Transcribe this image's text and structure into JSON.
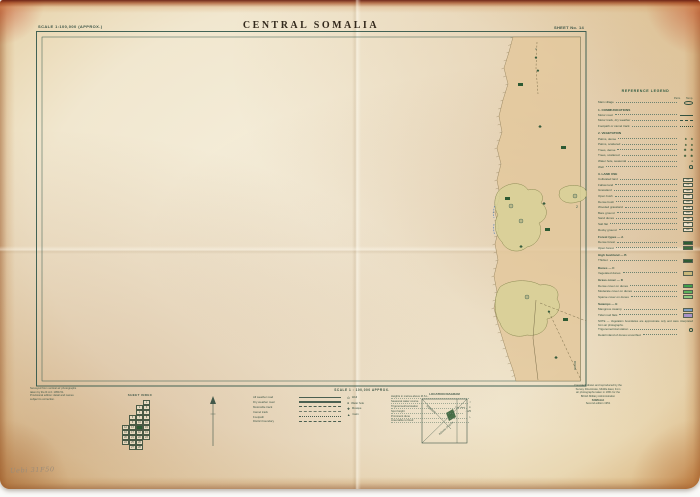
{
  "colors": {
    "frame": "#30564a",
    "title": "#33291c",
    "green_dark": "#2d5a33",
    "green_mid": "#57b35c",
    "green_light": "#8fcb82",
    "blue_swatch": "#7e9ec2",
    "purple_swatch": "#a892c6",
    "blue_ink": "#4a7ab5",
    "tan_strip": "#e3c89c",
    "veg": "#d8d098"
  },
  "header": {
    "scale_label": "SCALE 1:100,000 (APPROX.)",
    "title": "CENTRAL SOMALIA",
    "sheet_label": "SHEET No. 14"
  },
  "legend": {
    "heading": "REFERENCE LEGEND",
    "items": [
      {
        "t": "colheads",
        "a": "Perm.",
        "b": "Temp."
      },
      {
        "t": "item",
        "label": "Main village",
        "sym": "oval"
      },
      {
        "t": "section",
        "label": "1. COMMUNICATIONS"
      },
      {
        "t": "item",
        "label": "Motor road",
        "sym": "line"
      },
      {
        "t": "item",
        "label": "Motor track, dry weather",
        "sym": "dash"
      },
      {
        "t": "item",
        "label": "Footpath or camel track",
        "sym": "dots"
      },
      {
        "t": "section",
        "label": "2. VEGETATION"
      },
      {
        "t": "item",
        "label": "Palms, dense",
        "sym": "palm2"
      },
      {
        "t": "item",
        "label": "Palms, scattered",
        "sym": "palm2"
      },
      {
        "t": "item",
        "label": "Trees, dense",
        "sym": "tree2"
      },
      {
        "t": "item",
        "label": "Trees, scattered",
        "sym": "tree2"
      },
      {
        "t": "item",
        "label": "Water hole, seasonal",
        "sym": "dot"
      },
      {
        "t": "item",
        "label": "Well",
        "sym": "circledot"
      },
      {
        "t": "section",
        "label": "3. LAND USE"
      },
      {
        "t": "item",
        "label": "Cultivated land",
        "sym": "code",
        "code": "CL"
      },
      {
        "t": "item",
        "label": "Fallow land",
        "sym": "code",
        "code": "FL"
      },
      {
        "t": "item",
        "label": "Grassland",
        "sym": "code",
        "code": "GR"
      },
      {
        "t": "item",
        "label": "Open bush",
        "sym": "code",
        "code": "OB"
      },
      {
        "t": "item",
        "label": "Dense bush",
        "sym": "code",
        "code": "DB"
      },
      {
        "t": "item",
        "label": "Wooded grassland",
        "sym": "code",
        "code": "WG"
      },
      {
        "t": "item",
        "label": "Bare ground",
        "sym": "code",
        "code": "BG"
      },
      {
        "t": "item",
        "label": "Sand dunes",
        "sym": "code",
        "code": "SD"
      },
      {
        "t": "item",
        "label": "Salt flat",
        "sym": "code",
        "code": "SF"
      },
      {
        "t": "item",
        "label": "Rocky ground",
        "sym": "code",
        "code": "RK"
      },
      {
        "t": "section",
        "label": "Forest types — A"
      },
      {
        "t": "item",
        "label": "Dense forest",
        "sym": "swatch",
        "color": "#2e5b33"
      },
      {
        "t": "item",
        "label": "Open forest",
        "sym": "swatch",
        "color": "#3c6b3c"
      },
      {
        "t": "section",
        "label": "High bushland — B"
      },
      {
        "t": "item",
        "label": "Thicket",
        "sym": "swatch",
        "color": "#2e5b33"
      },
      {
        "t": "section",
        "label": "Dunes — C"
      },
      {
        "t": "item",
        "label": "Vegetated dunes",
        "sym": "swatch",
        "color": "#c9b87a"
      },
      {
        "t": "section",
        "label": "Grass cover — D"
      },
      {
        "t": "item",
        "label": "Dense cover on dunes",
        "sym": "swatch",
        "color": "#3fa04a"
      },
      {
        "t": "item",
        "label": "Moderate cover on dunes",
        "sym": "swatch",
        "color": "#5cb35c"
      },
      {
        "t": "item",
        "label": "Sparse cover on dunes",
        "sym": "swatch",
        "color": "#8fcb82"
      },
      {
        "t": "section",
        "label": "Swamps — E"
      },
      {
        "t": "item",
        "label": "Mangrove swamp",
        "sym": "swatch",
        "color": "#7e9ec2"
      },
      {
        "t": "item",
        "label": "Tidal mud flats",
        "sym": "swatch",
        "color": "#a892c6"
      },
      {
        "t": "note",
        "label": "NOTE — Vegetation boundaries are approximate only and were interpreted from air photographs."
      },
      {
        "t": "item",
        "label": "Trigonometrical station",
        "sym": "circledot"
      },
      {
        "t": "item",
        "label": "Detail inland of dunes unverified",
        "sym": "none"
      }
    ]
  },
  "map": {
    "coastal_strip": {
      "fill": "#e3c89c",
      "edge": [
        [
          513,
          37
        ],
        [
          509,
          52
        ],
        [
          504,
          68
        ],
        [
          508,
          84
        ],
        [
          503,
          100
        ],
        [
          499,
          116
        ],
        [
          502,
          132
        ],
        [
          497,
          148
        ],
        [
          501,
          164
        ],
        [
          497,
          180
        ],
        [
          500,
          196
        ],
        [
          495,
          212
        ],
        [
          499,
          228
        ],
        [
          495,
          244
        ],
        [
          498,
          260
        ],
        [
          494,
          276
        ],
        [
          497,
          292
        ],
        [
          494,
          308
        ],
        [
          498,
          324
        ],
        [
          503,
          340
        ],
        [
          508,
          356
        ],
        [
          513,
          370
        ],
        [
          516,
          381
        ]
      ]
    },
    "veg_fill": "#d8d098",
    "vegetation_polygons": [
      "M502,188C512,181 524,183 528,190C538,187 546,195 541,203C549,208 548,219 539,223C544,232 538,245 527,247C518,255 505,250 502,242C495,235 493,223 498,215C492,205 495,192 502,188Z",
      "M560,190C566,184 580,184 585,189C589,195 585,201 577,202C568,205 560,201 559,195Z",
      "M500,287C510,279 530,279 540,285C553,283 561,291 557,299C563,307 557,317 547,319C549,329 539,337 527,335C515,339 503,333 500,323C494,315 493,297 500,287Z"
    ],
    "tracks": [
      {
        "d": "M537,42 L536,68 L538,94",
        "dash": "2,1.6"
      },
      {
        "d": "M536,300 L533,338 L538,380",
        "dash": ""
      },
      {
        "d": "M540,303 L586,321",
        "dash": "2.6,1.8"
      },
      {
        "d": "M549,312 L581,380",
        "dash": "2.6,1.8"
      }
    ],
    "wells": [
      {
        "x": 521,
        "y": 221
      },
      {
        "x": 575,
        "y": 196
      },
      {
        "x": 527,
        "y": 297
      },
      {
        "x": 511,
        "y": 206
      }
    ],
    "buildings": [
      {
        "x": 518,
        "y": 83
      },
      {
        "x": 561,
        "y": 146
      },
      {
        "x": 545,
        "y": 228
      },
      {
        "x": 563,
        "y": 318
      },
      {
        "x": 505,
        "y": 197
      }
    ],
    "trees": [
      {
        "x": 536,
        "y": 59,
        "g": "♠"
      },
      {
        "x": 538,
        "y": 72,
        "g": "♠"
      },
      {
        "x": 540,
        "y": 128,
        "g": "♣"
      },
      {
        "x": 544,
        "y": 205,
        "g": "♣"
      },
      {
        "x": 521,
        "y": 248,
        "g": "♣"
      },
      {
        "x": 556,
        "y": 359,
        "g": "♣"
      },
      {
        "x": 549,
        "y": 313,
        "g": "♠"
      }
    ],
    "labels": [
      {
        "text": "2",
        "x": 577,
        "y": 208
      },
      {
        "text": "1",
        "x": 536,
        "y": 50,
        "s": 3
      }
    ]
  },
  "footer": {
    "left_note_lines": [
      "Surveyed from vertical air photographs",
      "taken by the R.A.F. 1950-51.",
      "Provisional edition: detail and names",
      "subject to correction."
    ],
    "sheet_index": {
      "title": "SHEET INDEX",
      "active": "14",
      "rows": [
        {
          "s": 3,
          "n": [
            "1"
          ]
        },
        {
          "s": 2,
          "n": [
            "2",
            "3"
          ]
        },
        {
          "s": 2,
          "n": [
            "4",
            "5"
          ]
        },
        {
          "s": 1,
          "n": [
            "6",
            "7",
            "8"
          ]
        },
        {
          "s": 1,
          "n": [
            "9",
            "10",
            "11"
          ]
        },
        {
          "s": 0,
          "n": [
            "12",
            "13",
            "14",
            "15"
          ]
        },
        {
          "s": 0,
          "n": [
            "16",
            "17",
            "18",
            "19"
          ]
        },
        {
          "s": 0,
          "n": [
            "20",
            "21",
            "22",
            "23"
          ]
        },
        {
          "s": 0,
          "n": [
            "24",
            "25",
            "26"
          ]
        },
        {
          "s": 1,
          "n": [
            "27",
            "28"
          ]
        }
      ]
    },
    "conversion": {
      "heading": "SCALE 1 : 100,000 APPROX.",
      "left_rows": [
        {
          "label": "All weather road",
          "style": "solid"
        },
        {
          "label": "Dry weather road",
          "style": "double"
        },
        {
          "label": "Motorable track",
          "style": "dash"
        },
        {
          "label": "Camel track",
          "style": "dashdot"
        },
        {
          "label": "Footpath",
          "style": "dots"
        },
        {
          "label": "District boundary",
          "style": "dash"
        }
      ],
      "mid_rows": [
        {
          "g": "⊙",
          "label": "Well"
        },
        {
          "g": "●",
          "label": "Water hole"
        },
        {
          "g": "✚",
          "label": "Mosque"
        },
        {
          "g": "▲",
          "label": "Cairn"
        }
      ],
      "right_rows": [
        {
          "label": "Heights in metres above M.S.L.",
          "tail": ""
        },
        {
          "label": "Seasonal water course",
          "tail": "≈"
        },
        {
          "label": "Trigonometrical station",
          "tail": "⊙"
        },
        {
          "label": "Spot height",
          "tail": "· 125"
        },
        {
          "label": "Prominent dune",
          "tail": "∿"
        },
        {
          "label": "Area liable to flood",
          "tail": ""
        }
      ]
    },
    "location": {
      "title": "LOCATION DIAGRAM",
      "label_a": "SOMALIA",
      "label_b": "INDIAN OCEAN",
      "label_c": "This sheet"
    },
    "imprint_lines": [
      "Compiled, drawn and reproduced by the",
      "Survey Directorate, Middle East, from",
      "air photographs taken in 1951 for the",
      "British Military Administration",
      "SOMALIA",
      "Second edition 1951"
    ],
    "handwritten": "Uebi 31F50"
  }
}
